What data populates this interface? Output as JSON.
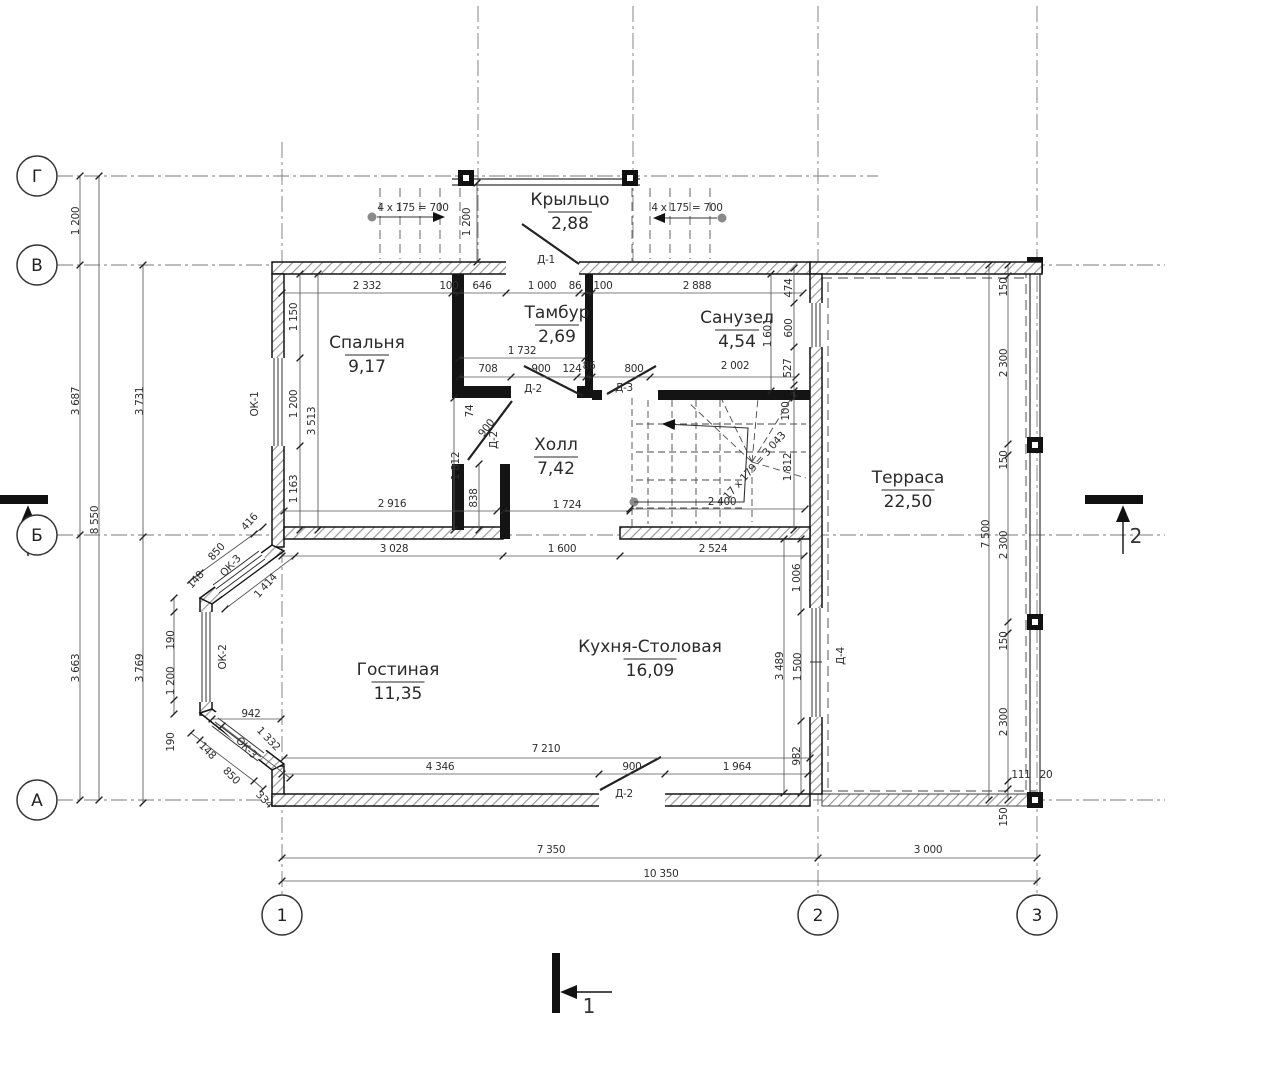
{
  "plan": {
    "colors": {
      "wall": "#141414",
      "dim": "#3c3c3c",
      "axis_line": "#777777",
      "bg": "#ffffff",
      "accent_dot": "#8a8a8a"
    },
    "axes": {
      "rows": [
        {
          "label": "Г",
          "y": 176
        },
        {
          "label": "В",
          "y": 265
        },
        {
          "label": "Б",
          "y": 535
        },
        {
          "label": "А",
          "y": 800
        }
      ],
      "cols": [
        {
          "label": "1",
          "x": 282
        },
        {
          "label": "2",
          "x": 818
        },
        {
          "label": "3",
          "x": 1037
        }
      ]
    },
    "rooms": [
      {
        "name": "Крыльцо",
        "area": "2,88",
        "x": 570,
        "y": 205
      },
      {
        "name": "Тамбур",
        "area": "2,69",
        "x": 557,
        "y": 318
      },
      {
        "name": "Спальня",
        "area": "9,17",
        "x": 367,
        "y": 348
      },
      {
        "name": "Санузел",
        "area": "4,54",
        "x": 737,
        "y": 323
      },
      {
        "name": "Холл",
        "area": "7,42",
        "x": 556,
        "y": 450
      },
      {
        "name": "Терраса",
        "area": "22,50",
        "x": 908,
        "y": 483
      },
      {
        "name": "Гостиная",
        "area": "11,35",
        "x": 398,
        "y": 675
      },
      {
        "name": "Кухня-Столовая",
        "area": "16,09",
        "x": 650,
        "y": 652
      }
    ],
    "sections": [
      {
        "label": "2",
        "x": 1136,
        "y": 543
      },
      {
        "label": "1",
        "x": 589,
        "y": 1013
      }
    ],
    "dim_texts": [
      {
        "t": "2 332",
        "x": 367,
        "y": 289
      },
      {
        "t": "100",
        "x": 449,
        "y": 289,
        "s": 8.5
      },
      {
        "t": "646",
        "x": 482,
        "y": 289
      },
      {
        "t": "1 000",
        "x": 542,
        "y": 289
      },
      {
        "t": "86",
        "x": 575,
        "y": 289,
        "s": 8.5
      },
      {
        "t": "100",
        "x": 603,
        "y": 289,
        "s": 8.5
      },
      {
        "t": "2 888",
        "x": 697,
        "y": 289
      },
      {
        "t": "1 200",
        "x": 470,
        "y": 222,
        "r": -90
      },
      {
        "t": "Д-1",
        "x": 546,
        "y": 263,
        "s": 10
      },
      {
        "t": "4 x 175 = 700",
        "x": 413,
        "y": 211,
        "s": 8
      },
      {
        "t": "4 x 175 = 700",
        "x": 687,
        "y": 211,
        "s": 8
      },
      {
        "t": "1 732",
        "x": 522,
        "y": 354
      },
      {
        "t": "708",
        "x": 488,
        "y": 372
      },
      {
        "t": "900",
        "x": 541,
        "y": 372
      },
      {
        "t": "124",
        "x": 572,
        "y": 372,
        "s": 9
      },
      {
        "t": "86",
        "x": 589,
        "y": 369,
        "s": 8
      },
      {
        "t": "800",
        "x": 634,
        "y": 372
      },
      {
        "t": "2 002",
        "x": 735,
        "y": 369
      },
      {
        "t": "1 150",
        "x": 297,
        "y": 317,
        "r": -90
      },
      {
        "t": "1 200",
        "x": 297,
        "y": 404,
        "r": -90
      },
      {
        "t": "1 163",
        "x": 297,
        "y": 489,
        "r": -90
      },
      {
        "t": "3 513",
        "x": 315,
        "y": 421,
        "r": -90
      },
      {
        "t": "2 916",
        "x": 392,
        "y": 507
      },
      {
        "t": "ОК-1",
        "x": 258,
        "y": 404,
        "r": -90,
        "s": 10
      },
      {
        "t": "74",
        "x": 473,
        "y": 411,
        "r": -90,
        "s": 8
      },
      {
        "t": "900",
        "x": 489,
        "y": 430,
        "r": -52,
        "s": 9
      },
      {
        "t": "1 812",
        "x": 459,
        "y": 466,
        "r": -90
      },
      {
        "t": "838",
        "x": 477,
        "y": 498,
        "r": -90,
        "s": 10
      },
      {
        "t": "Д-2",
        "x": 497,
        "y": 440,
        "r": -90,
        "s": 10
      },
      {
        "t": "Д-2",
        "x": 533,
        "y": 392,
        "s": 10
      },
      {
        "t": "Д-3",
        "x": 624,
        "y": 391,
        "s": 10
      },
      {
        "t": "474",
        "x": 792,
        "y": 288,
        "r": -90,
        "s": 8.5
      },
      {
        "t": "600",
        "x": 792,
        "y": 328,
        "r": -90,
        "s": 8.5
      },
      {
        "t": "1 601",
        "x": 771,
        "y": 333,
        "r": -90
      },
      {
        "t": "527",
        "x": 791,
        "y": 368,
        "r": -90,
        "s": 8.5
      },
      {
        "t": "100",
        "x": 789,
        "y": 411,
        "r": -90,
        "s": 8.5
      },
      {
        "t": "1 812",
        "x": 791,
        "y": 467,
        "r": -90
      },
      {
        "t": "2 400",
        "x": 722,
        "y": 505
      },
      {
        "t": "17 x 179 = 3 043",
        "x": 757,
        "y": 468,
        "r": -48,
        "s": 7
      },
      {
        "t": "1 724",
        "x": 567,
        "y": 508
      },
      {
        "t": "3 028",
        "x": 394,
        "y": 552
      },
      {
        "t": "1 600",
        "x": 562,
        "y": 552
      },
      {
        "t": "2 524",
        "x": 713,
        "y": 552
      },
      {
        "t": "416",
        "x": 252,
        "y": 524,
        "r": -48,
        "s": 9
      },
      {
        "t": "850",
        "x": 219,
        "y": 554,
        "r": -48
      },
      {
        "t": "ОК-3",
        "x": 233,
        "y": 568,
        "r": -48,
        "s": 9
      },
      {
        "t": "148",
        "x": 198,
        "y": 582,
        "r": -48,
        "s": 8
      },
      {
        "t": "1 414",
        "x": 268,
        "y": 588,
        "r": -48
      },
      {
        "t": "190",
        "x": 174,
        "y": 640,
        "r": -90,
        "s": 9
      },
      {
        "t": "1 200",
        "x": 174,
        "y": 681,
        "r": -90
      },
      {
        "t": "190",
        "x": 174,
        "y": 742,
        "r": -90,
        "s": 9
      },
      {
        "t": "ОК-2",
        "x": 226,
        "y": 657,
        "r": -90,
        "s": 9
      },
      {
        "t": "942",
        "x": 251,
        "y": 717
      },
      {
        "t": "1 332",
        "x": 266,
        "y": 741,
        "r": 46
      },
      {
        "t": "ОК-3",
        "x": 244,
        "y": 750,
        "r": 46,
        "s": 9
      },
      {
        "t": "148",
        "x": 205,
        "y": 753,
        "r": 46,
        "s": 8
      },
      {
        "t": "850",
        "x": 229,
        "y": 778,
        "r": 46
      },
      {
        "t": "334",
        "x": 262,
        "y": 802,
        "r": 46,
        "s": 9
      },
      {
        "t": "1 006",
        "x": 800,
        "y": 578,
        "r": -90
      },
      {
        "t": "1 500",
        "x": 801,
        "y": 667,
        "r": -90
      },
      {
        "t": "982",
        "x": 800,
        "y": 756,
        "r": -90
      },
      {
        "t": "3 489",
        "x": 783,
        "y": 666,
        "r": -90
      },
      {
        "t": "Д-4",
        "x": 844,
        "y": 656,
        "r": -90,
        "s": 10
      },
      {
        "t": "7 210",
        "x": 546,
        "y": 752
      },
      {
        "t": "4 346",
        "x": 440,
        "y": 770
      },
      {
        "t": "900",
        "x": 632,
        "y": 770
      },
      {
        "t": "1 964",
        "x": 737,
        "y": 770
      },
      {
        "t": "Д-2",
        "x": 624,
        "y": 797,
        "s": 10
      },
      {
        "t": "1 200",
        "x": 79,
        "y": 221,
        "r": -90
      },
      {
        "t": "3 687",
        "x": 79,
        "y": 401,
        "r": -90
      },
      {
        "t": "3 663",
        "x": 79,
        "y": 668,
        "r": -90
      },
      {
        "t": "8 550",
        "x": 98,
        "y": 520,
        "r": -90
      },
      {
        "t": "3 731",
        "x": 143,
        "y": 401,
        "r": -90
      },
      {
        "t": "3 769",
        "x": 143,
        "y": 668,
        "r": -90
      },
      {
        "t": "150",
        "x": 1007,
        "y": 287,
        "r": -90,
        "s": 8.5
      },
      {
        "t": "2 300",
        "x": 1007,
        "y": 363,
        "r": -90
      },
      {
        "t": "150",
        "x": 1007,
        "y": 460,
        "r": -90,
        "s": 8.5
      },
      {
        "t": "2 300",
        "x": 1007,
        "y": 545,
        "r": -90
      },
      {
        "t": "150",
        "x": 1007,
        "y": 641,
        "r": -90,
        "s": 8.5
      },
      {
        "t": "2 300",
        "x": 1007,
        "y": 722,
        "r": -90
      },
      {
        "t": "111",
        "x": 1021,
        "y": 778,
        "s": 8
      },
      {
        "t": "20",
        "x": 1046,
        "y": 778,
        "s": 8
      },
      {
        "t": "150",
        "x": 1007,
        "y": 817,
        "r": -90,
        "s": 8.5
      },
      {
        "t": "7 500",
        "x": 989,
        "y": 534,
        "r": -90
      },
      {
        "t": "7 350",
        "x": 551,
        "y": 853
      },
      {
        "t": "3 000",
        "x": 928,
        "y": 853
      },
      {
        "t": "10 350",
        "x": 661,
        "y": 877
      }
    ]
  }
}
